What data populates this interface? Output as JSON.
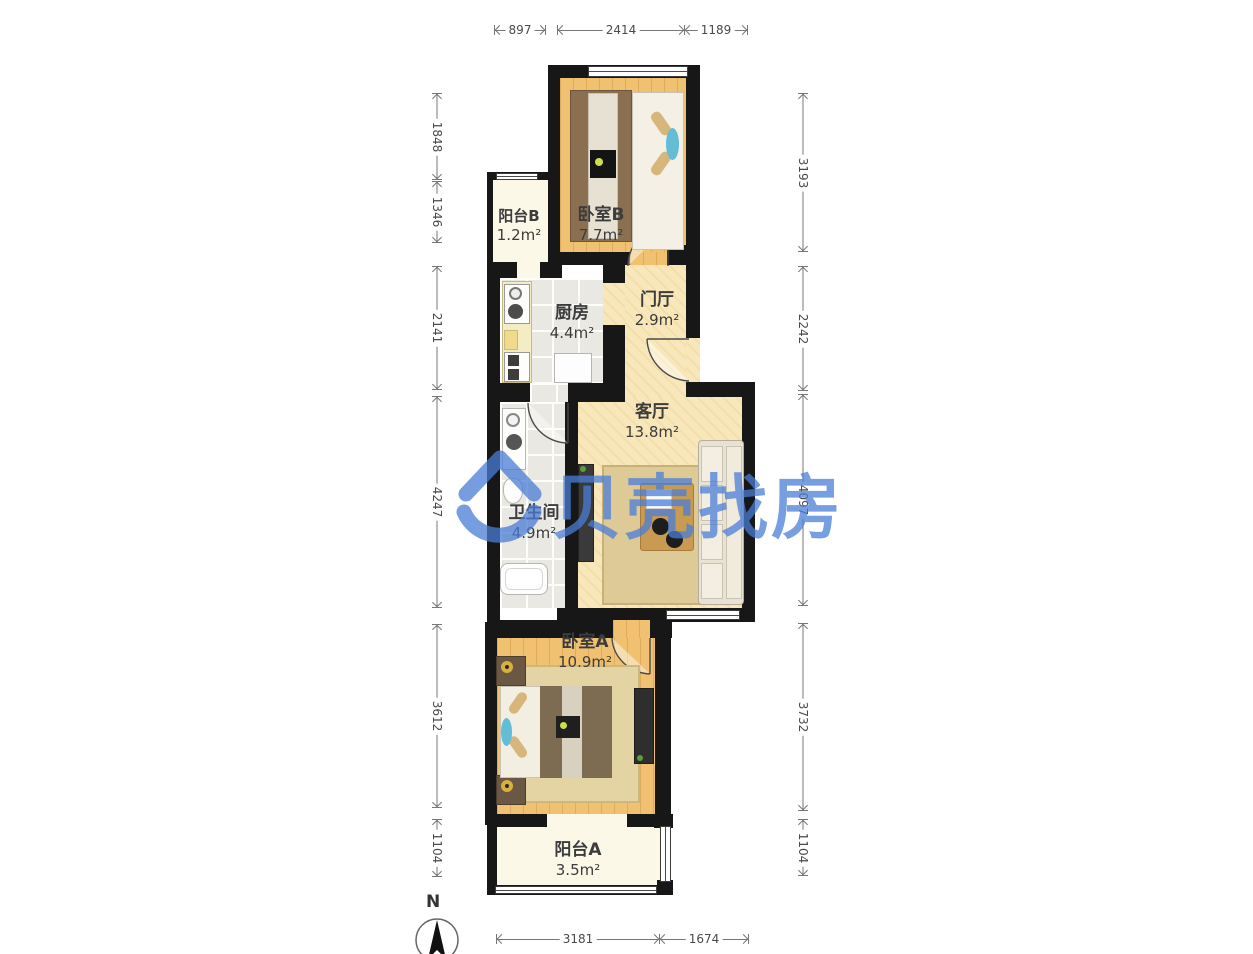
{
  "watermark": {
    "text": "贝壳找房",
    "color": "#4a7dd7"
  },
  "compass": {
    "label": "N"
  },
  "rooms": {
    "balcony_b": {
      "name": "阳台B",
      "area": "1.2m²"
    },
    "bedroom_b": {
      "name": "卧室B",
      "area": "7.7m²"
    },
    "kitchen": {
      "name": "厨房",
      "area": "4.4m²"
    },
    "hall": {
      "name": "门厅",
      "area": "2.9m²"
    },
    "living": {
      "name": "客厅",
      "area": "13.8m²"
    },
    "bathroom": {
      "name": "卫生间",
      "area": "4.9m²"
    },
    "bedroom_a": {
      "name": "卧室A",
      "area": "10.9m²"
    },
    "balcony_a": {
      "name": "阳台A",
      "area": "3.5m²"
    }
  },
  "dimensions": {
    "top": [
      "897",
      "2414",
      "1189"
    ],
    "bottom": [
      "3181",
      "1674"
    ],
    "left": [
      "1848",
      "1346",
      "2141",
      "4247",
      "3612",
      "1104"
    ],
    "right": [
      "3193",
      "2242",
      "4097",
      "3732",
      "1104"
    ]
  }
}
